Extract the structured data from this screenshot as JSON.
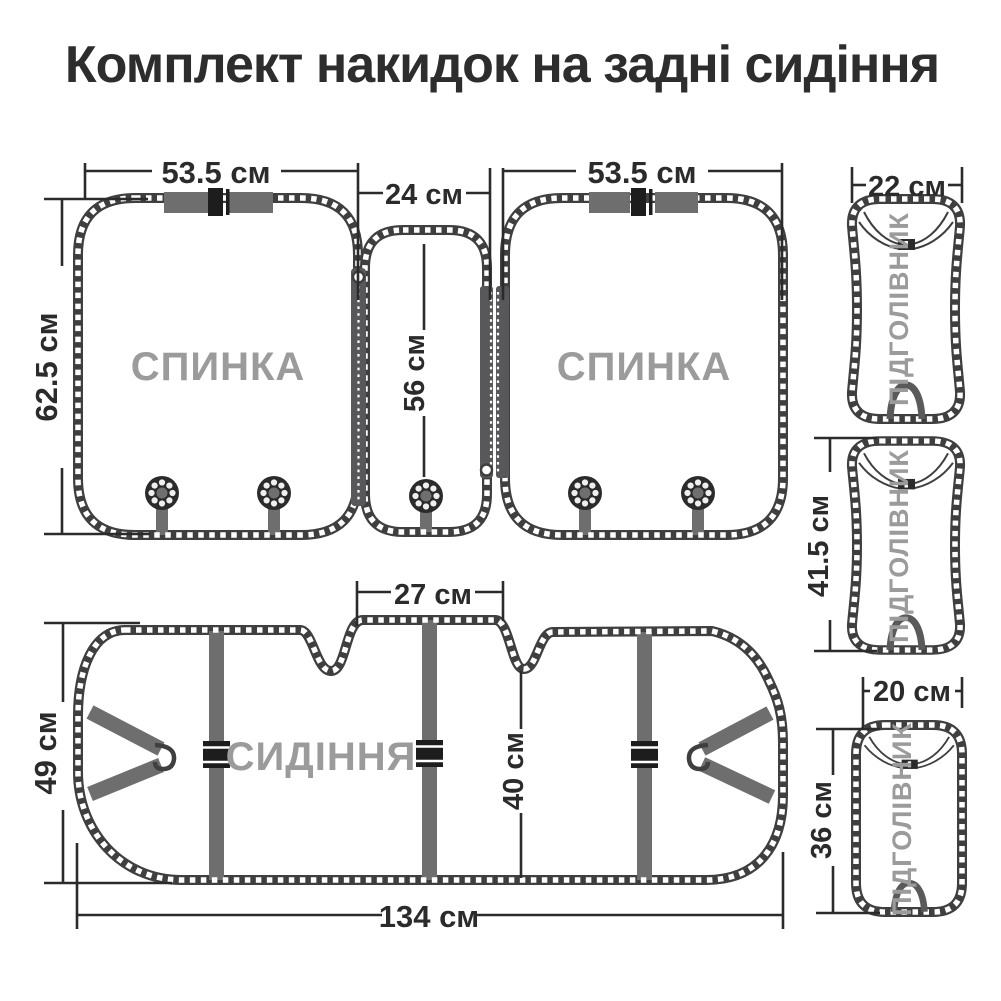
{
  "title": "Комплект накидок на задні сидіння",
  "labels": {
    "backrest_left": "СПИНКА",
    "backrest_right": "СПИНКА",
    "seat": "СИДІННЯ",
    "headrest_top": "ПІДГОЛІВНИК",
    "headrest_middle": "ПІДГОЛІВНИК",
    "headrest_bottom": "ПІДГОЛІВНИК"
  },
  "dimensions": {
    "backrest_left_width": "53.5 см",
    "backrest_left_height": "62.5 см",
    "center_panel_width": "24 см",
    "center_panel_height": "56 см",
    "backrest_right_width": "53.5 см",
    "headrest_top_width": "22 см",
    "headrest_middle_height": "41.5 см",
    "headrest_bottom_width": "20 см",
    "headrest_bottom_height": "36 см",
    "seat_height": "49 см",
    "seat_tab_width": "27 см",
    "seat_depth": "40 см",
    "seat_width": "134 см"
  },
  "colors": {
    "outline": "#3f3f3f",
    "piece_label": "#9b9b9b",
    "dimension_text": "#2b2b2b",
    "strap": "#6e6e6e",
    "buckle": "#1d1d1d",
    "background": "#ffffff"
  }
}
